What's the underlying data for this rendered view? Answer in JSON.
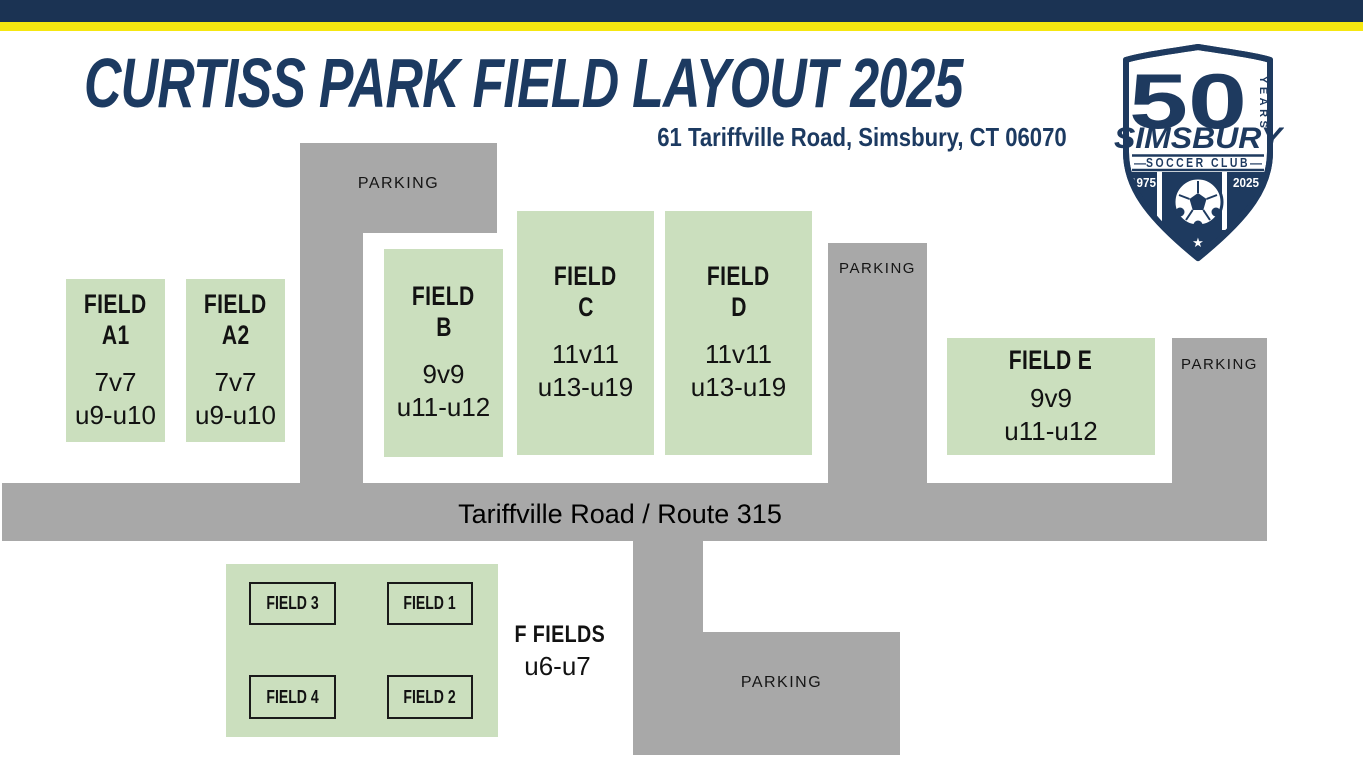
{
  "header": {
    "title": "CURTISS PARK FIELD LAYOUT 2025",
    "subtitle": "61 Tariffville Road, Simsbury, CT 06070"
  },
  "logo": {
    "years_number": "50",
    "years_label": "YEARS",
    "club_name": "SIMSBURY",
    "club_type": "SOCCER CLUB",
    "left_dash": "—",
    "right_dash": "—",
    "year_founded": "1975",
    "year_current": "2025",
    "star": "★"
  },
  "parking": {
    "label": "PARKING"
  },
  "road": {
    "label": "Tariffville Road / Route 315"
  },
  "fields": {
    "a1": {
      "t1": "FIELD",
      "t2": "A1",
      "spec1": "7v7",
      "spec2": "u9-u10"
    },
    "a2": {
      "t1": "FIELD",
      "t2": "A2",
      "spec1": "7v7",
      "spec2": "u9-u10"
    },
    "b": {
      "t1": "FIELD",
      "t2": "B",
      "spec1": "9v9",
      "spec2": "u11-u12"
    },
    "c": {
      "t1": "FIELD",
      "t2": "C",
      "spec1": "11v11",
      "spec2": "u13-u19"
    },
    "d": {
      "t1": "FIELD",
      "t2": "D",
      "spec1": "11v11",
      "spec2": "u13-u19"
    },
    "e": {
      "t1": "FIELD E",
      "spec1": "9v9",
      "spec2": "u11-u12"
    }
  },
  "f_fields": {
    "label": "F FIELDS",
    "ages": "u6-u7",
    "box_top_left": "FIELD 3",
    "box_top_right": "FIELD 1",
    "box_bottom_left": "FIELD 4",
    "box_bottom_right": "FIELD 2"
  },
  "colors": {
    "navy": "#1c3a61",
    "logo_navy": "#1e3a5f",
    "yellow": "#f6e711",
    "field_green": "#cbdfbe",
    "parking_gray": "#a8a8a8",
    "text_black": "#121212"
  }
}
